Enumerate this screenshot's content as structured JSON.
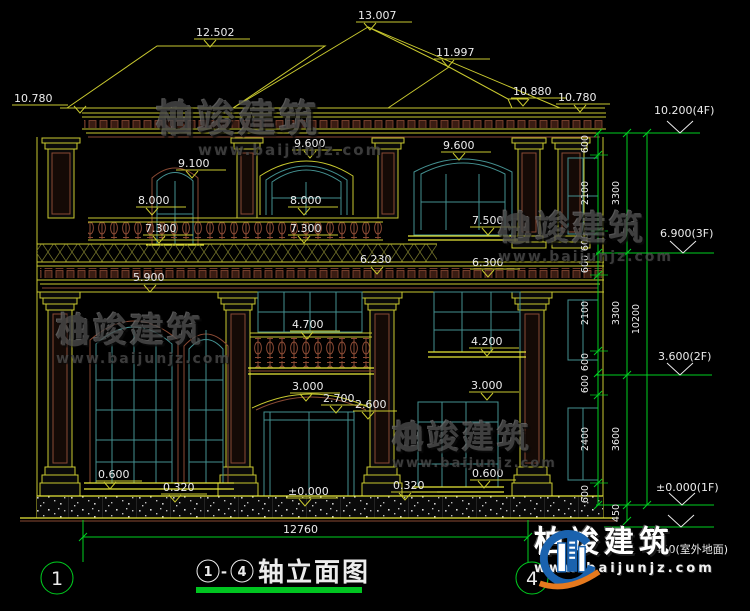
{
  "watermark": {
    "brand": "柏竣建筑",
    "url": "www.baijunjz.com"
  },
  "labels": [
    {
      "id": "roof-ridge-left",
      "text": "12.502"
    },
    {
      "id": "roof-peak",
      "text": "13.007"
    },
    {
      "id": "roof-sub-ridge",
      "text": "11.997"
    },
    {
      "id": "roof-eave-step",
      "text": "10.880"
    },
    {
      "id": "roof-eave-right",
      "text": "10.780"
    },
    {
      "id": "roof-eave-left",
      "text": "10.780"
    },
    {
      "id": "win-3f-center-top",
      "text": "9.600"
    },
    {
      "id": "win-3f-right-top",
      "text": "9.600"
    },
    {
      "id": "win-3f-left-arch",
      "text": "9.100"
    },
    {
      "id": "transom-3f-left",
      "text": "8.000"
    },
    {
      "id": "transom-3f-center",
      "text": "8.000"
    },
    {
      "id": "sill-3f-right",
      "text": "7.500"
    },
    {
      "id": "rail-3f-left",
      "text": "7.300"
    },
    {
      "id": "rail-3f-center",
      "text": "7.300"
    },
    {
      "id": "cornice-2f-center",
      "text": "6.230"
    },
    {
      "id": "cornice-2f-right",
      "text": "6.300"
    },
    {
      "id": "cornice-2f-left",
      "text": "5.900"
    },
    {
      "id": "balcony-rail-2f",
      "text": "4.700"
    },
    {
      "id": "sill-2f-right",
      "text": "4.200"
    },
    {
      "id": "entry-arch-top",
      "text": "3.000"
    },
    {
      "id": "entry-arch-spring",
      "text": "2.700"
    },
    {
      "id": "entry-door-top",
      "text": "2.600"
    },
    {
      "id": "band-1f-right",
      "text": "3.000"
    },
    {
      "id": "sill-1f-left",
      "text": "0.600"
    },
    {
      "id": "plinth-left",
      "text": "0.320"
    },
    {
      "id": "sill-1f-right",
      "text": "0.600"
    },
    {
      "id": "plinth-right",
      "text": "0.320"
    },
    {
      "id": "floor-1f-entry",
      "text": "±0.000"
    }
  ],
  "right_stack": {
    "levels": [
      {
        "id": "level-4f",
        "text": "10.200(4F)"
      },
      {
        "id": "level-3f",
        "text": "6.900(3F)"
      },
      {
        "id": "level-2f",
        "text": "3.600(2F)"
      },
      {
        "id": "level-1f",
        "text": "±0.000(1F)"
      },
      {
        "id": "level-ground",
        "text": "-0.450(室外地面)"
      }
    ],
    "chain_inner": [
      "600",
      "2100",
      "600",
      "600",
      "2100",
      "600",
      "600",
      "2400",
      "600"
    ],
    "chain_mid": [
      "3300",
      "3300",
      "3600",
      "450"
    ],
    "total": "10200"
  },
  "bottom": {
    "overall_width": "12760",
    "axis_left": "1",
    "axis_right": "4",
    "title_axis_left": "1",
    "title_dash": "-",
    "title_axis_right": "4",
    "title_text": "轴立面图"
  },
  "colors": {
    "cad_yellow": "#c9c92f",
    "cad_green": "#00d020",
    "frame_teal": "#449090",
    "trim_brown": "#8a4a34",
    "logo_blue": "#1a62ae",
    "logo_orange": "#e5791e"
  }
}
